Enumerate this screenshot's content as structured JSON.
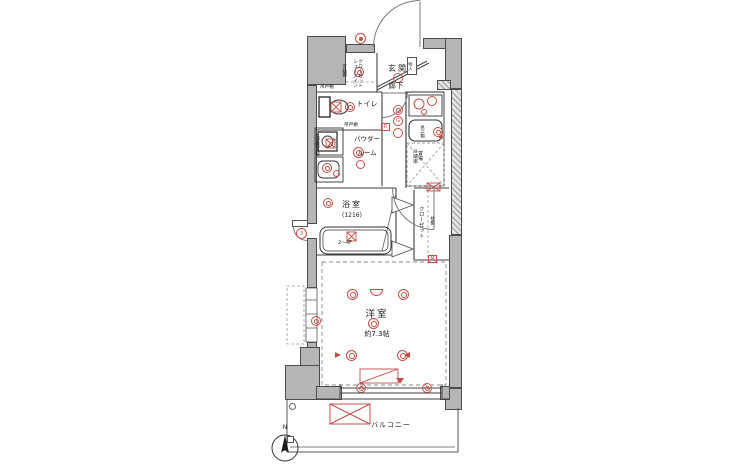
{
  "colors": {
    "accent_red": "#c05048",
    "wall": "#b5b5b5",
    "line": "#3f3f3f"
  },
  "labels": {
    "genkan": "玄関",
    "sic": "シューズイン\nクローゼット",
    "kadodana": "可動棚",
    "toilet": "トイレ",
    "tsuridana_a": "吊戸棚",
    "tsuridana_b": "吊戸棚",
    "tsuridana_k": "吊戸棚",
    "laundry": "洗濯機置場",
    "powder1": "パウダー",
    "powder2": "ルーム",
    "rouka": "廊下",
    "fridge": "冷蔵庫\n置場",
    "bath": "浴室",
    "bath_size": "(1216)",
    "bath_floor": "2〜4F",
    "closet": "クローゼット",
    "makuradana": "枕棚",
    "mono": "物入",
    "room": "洋室",
    "room_size": "約7.3帖",
    "balcony": "バルコニー",
    "north": "N"
  },
  "symbols": {
    "gas": "G",
    "remote": "R",
    "meter": "M",
    "door_num": "3"
  }
}
